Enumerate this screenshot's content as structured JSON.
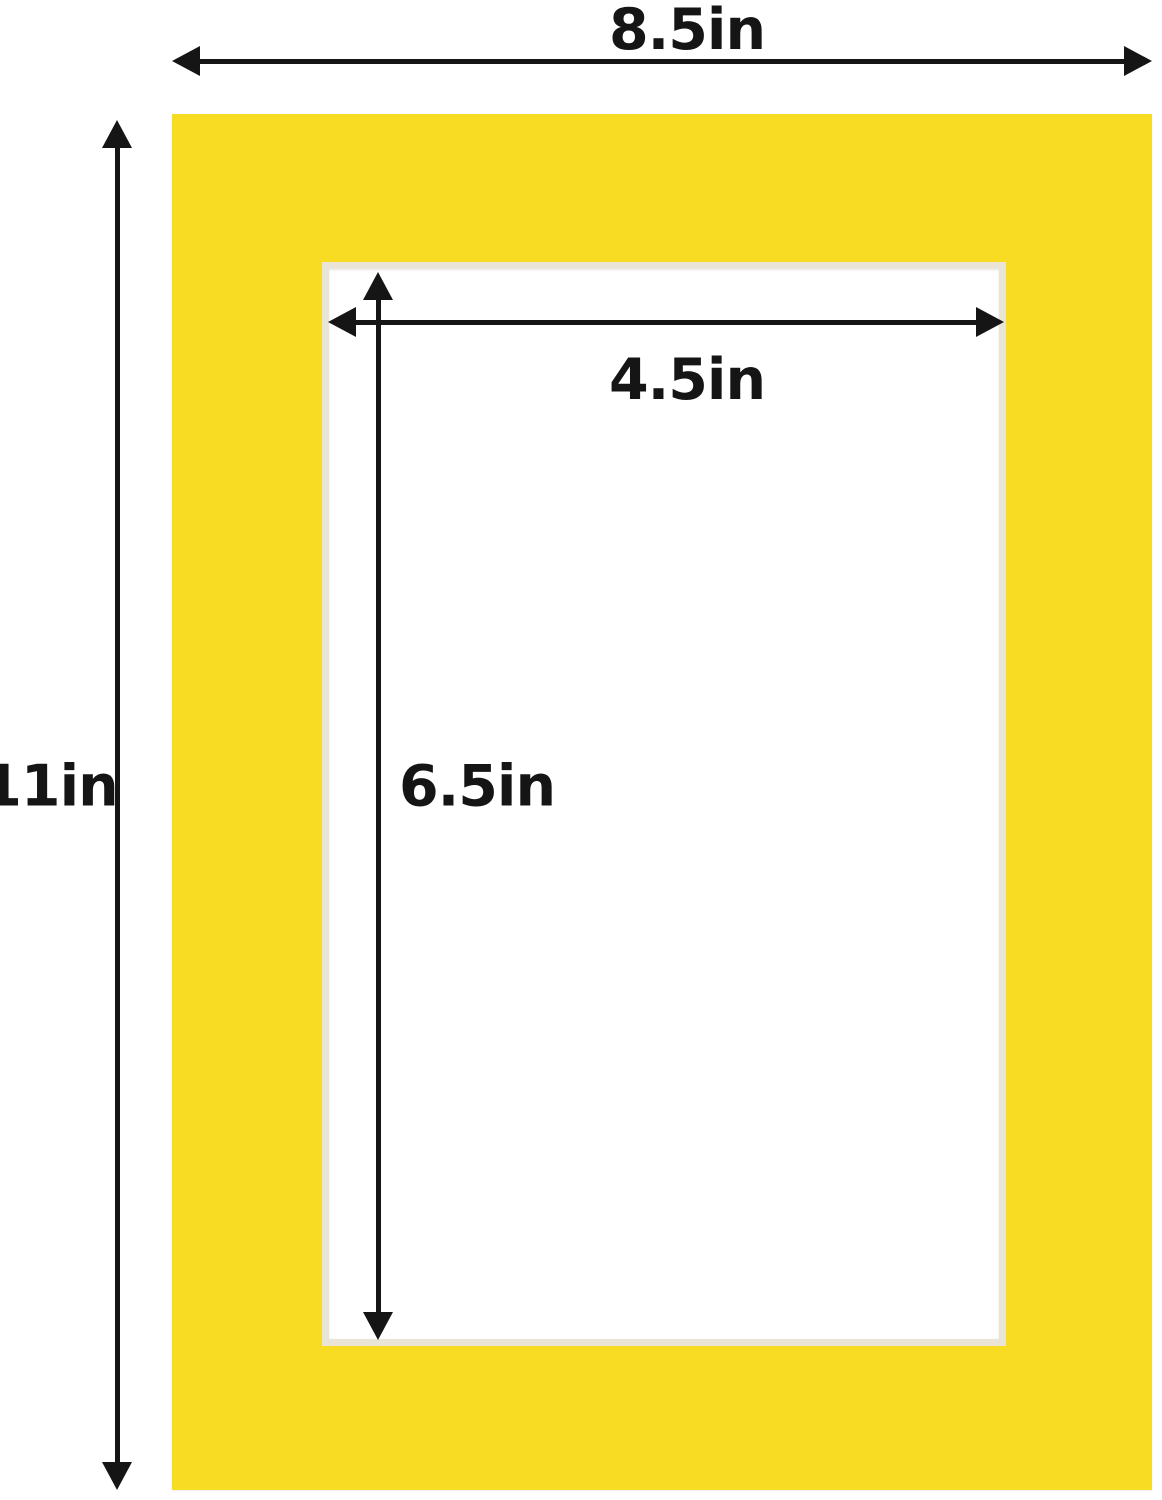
{
  "diagram": {
    "outer": {
      "width_label": "8.5in",
      "height_label": "11in"
    },
    "opening": {
      "width_label": "4.5in",
      "height_label": "6.5in"
    },
    "colors": {
      "mat": "#F8DB23",
      "bevel": "#E9E4D6",
      "arrow": "#151515",
      "background": "#FFFFFF"
    }
  }
}
